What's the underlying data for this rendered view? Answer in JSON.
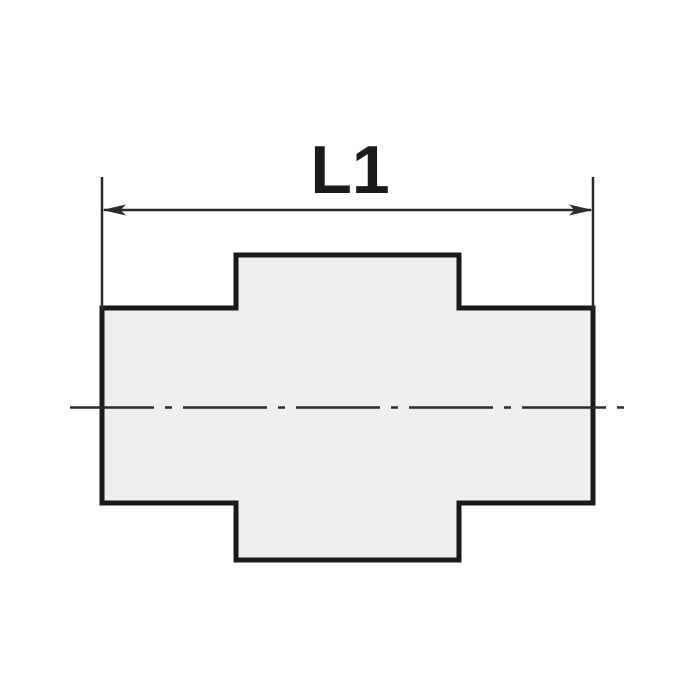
{
  "figure": {
    "dimension_label": "L1"
  },
  "colors": {
    "background": "#ffffff",
    "part_fill": "#efefef",
    "outline": "#1a1a1a",
    "thin_line": "#2b2b2b",
    "label_color": "#1a1a1a"
  }
}
